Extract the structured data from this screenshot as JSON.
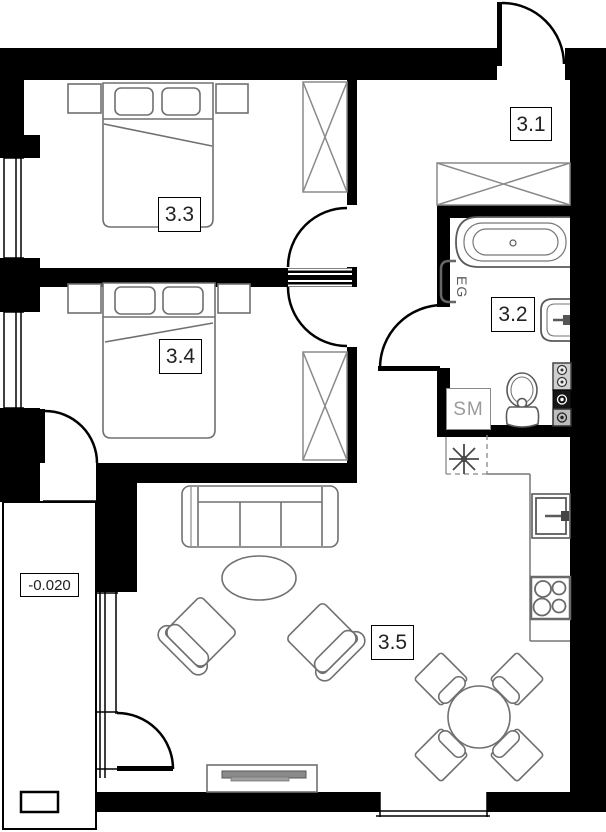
{
  "rooms": [
    {
      "number": "3.1"
    },
    {
      "number": "3.2"
    },
    {
      "number": "3.3"
    },
    {
      "number": "3.4"
    },
    {
      "number": "3.5"
    }
  ],
  "labels": {
    "elevation": "-0.020",
    "washing_machine": "SM",
    "towel_radiator": "EG"
  },
  "colors": {
    "wall": "#000000",
    "furniture_outline": "#707070",
    "fixture_outline": "#555555",
    "background": "#ffffff"
  }
}
